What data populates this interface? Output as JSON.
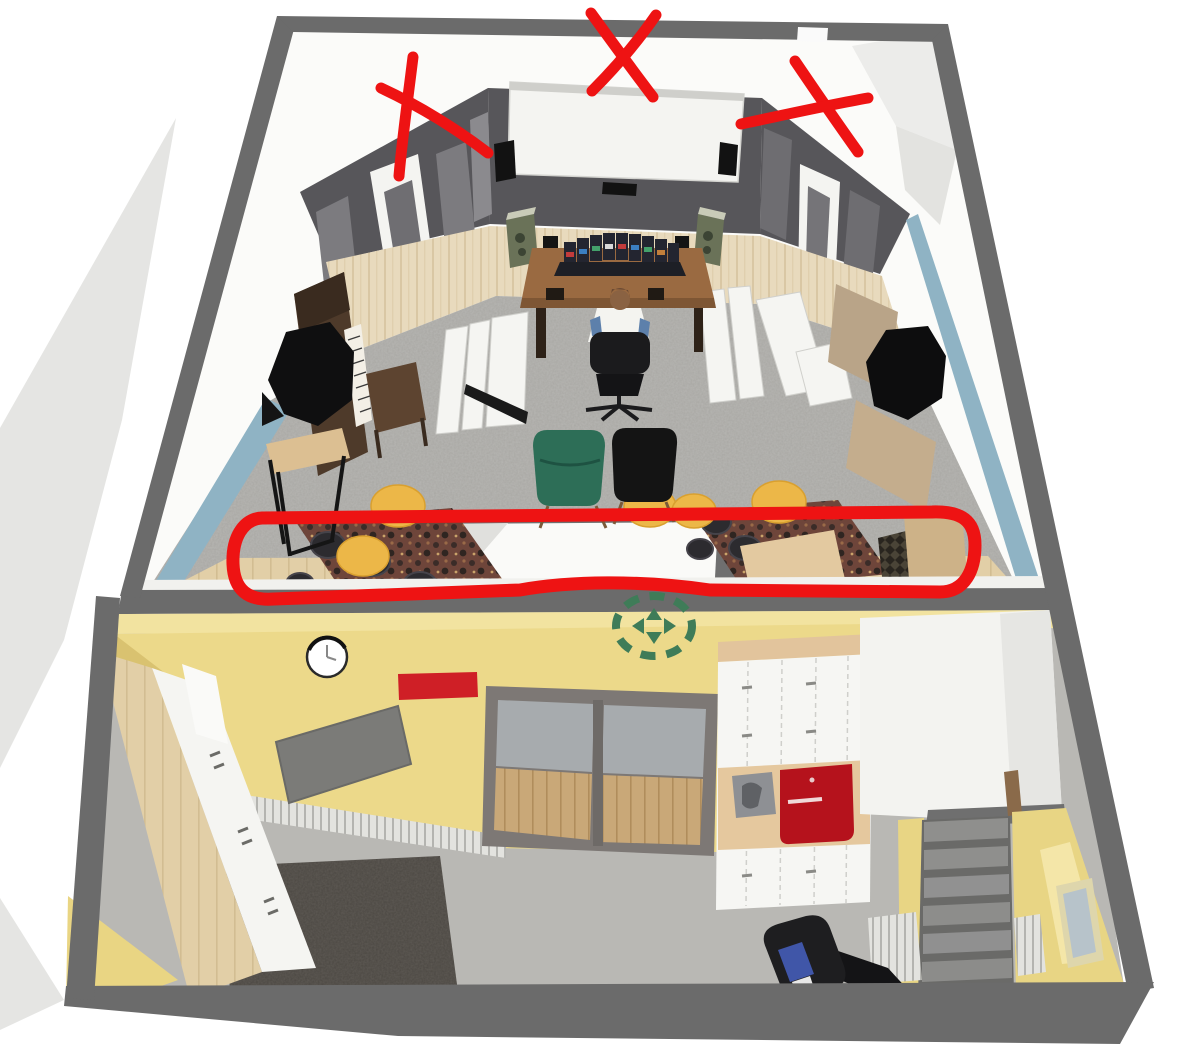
{
  "scene": {
    "kind": "3d-floorplan-render-annotated",
    "rooms": {
      "studio": {
        "name": "studio-cinema-room",
        "items": [
          "projector-screen",
          "lcr-speakers",
          "acoustic-panels",
          "doors",
          "mixing-desk",
          "studio-monitors",
          "camo-speakers",
          "office-chair",
          "person",
          "upright-piano",
          "piano-bench",
          "bass-trap-octagon",
          "bass-trap-hexagon",
          "white-floor-panels",
          "wingback-chair-green",
          "wingback-chair-black",
          "round-floor-cushions",
          "pattern-rugs",
          "dark-poufs",
          "bar-table",
          "wood-cabinets",
          "stairwell-opening"
        ]
      },
      "hobby": {
        "name": "hobby-laundry-room",
        "items": [
          "wall-clock",
          "red-wall-panel",
          "tilted-gray-board",
          "radiator",
          "sliding-glass-door",
          "compass-marker",
          "cabinet-run",
          "sewing-machine",
          "red-cabinet",
          "white-stair-enclosure",
          "staircase",
          "window",
          "radiators",
          "treadmill",
          "shag-rug",
          "counter-cabinets",
          "corner-wall"
        ]
      }
    },
    "annotations": {
      "color": "#ee1313",
      "x_marks": [
        {
          "cx": 434,
          "cy": 115
        },
        {
          "cx": 622,
          "cy": 54
        },
        {
          "cx": 805,
          "cy": 110
        }
      ],
      "loop": {
        "x": 232,
        "y": 511,
        "width": 744,
        "height": 90
      }
    }
  },
  "palette": {
    "wall_outer": "#6b6b6b",
    "wall_dark": "#57565a",
    "panel_gray": "#7c7b7f",
    "screen": "#f4f4f1",
    "wood_wall": "#e8dabd",
    "blue_wall": "#8fb3c4",
    "floor_studio": "#a8a7a3",
    "floor_lower": "#b9b8b4",
    "yellow_top": "#f2e3a0",
    "yellow_wall": "#ecd98a",
    "yellow_dark": "#d9c270",
    "chair_green": "#2d6e57",
    "cushion_yellow": "#ecb748",
    "rug_base": "#6e453a",
    "rug_shag": "#4b4742",
    "red_accent": "#cf1f26",
    "red_cabinet": "#b5121c",
    "compass_green": "#3f7c58",
    "annotation_red": "#ee1313",
    "desk_wood": "#9a6a41",
    "stair_tread": "#8f8f8d",
    "exterior_gray": "#e5e5e3"
  }
}
